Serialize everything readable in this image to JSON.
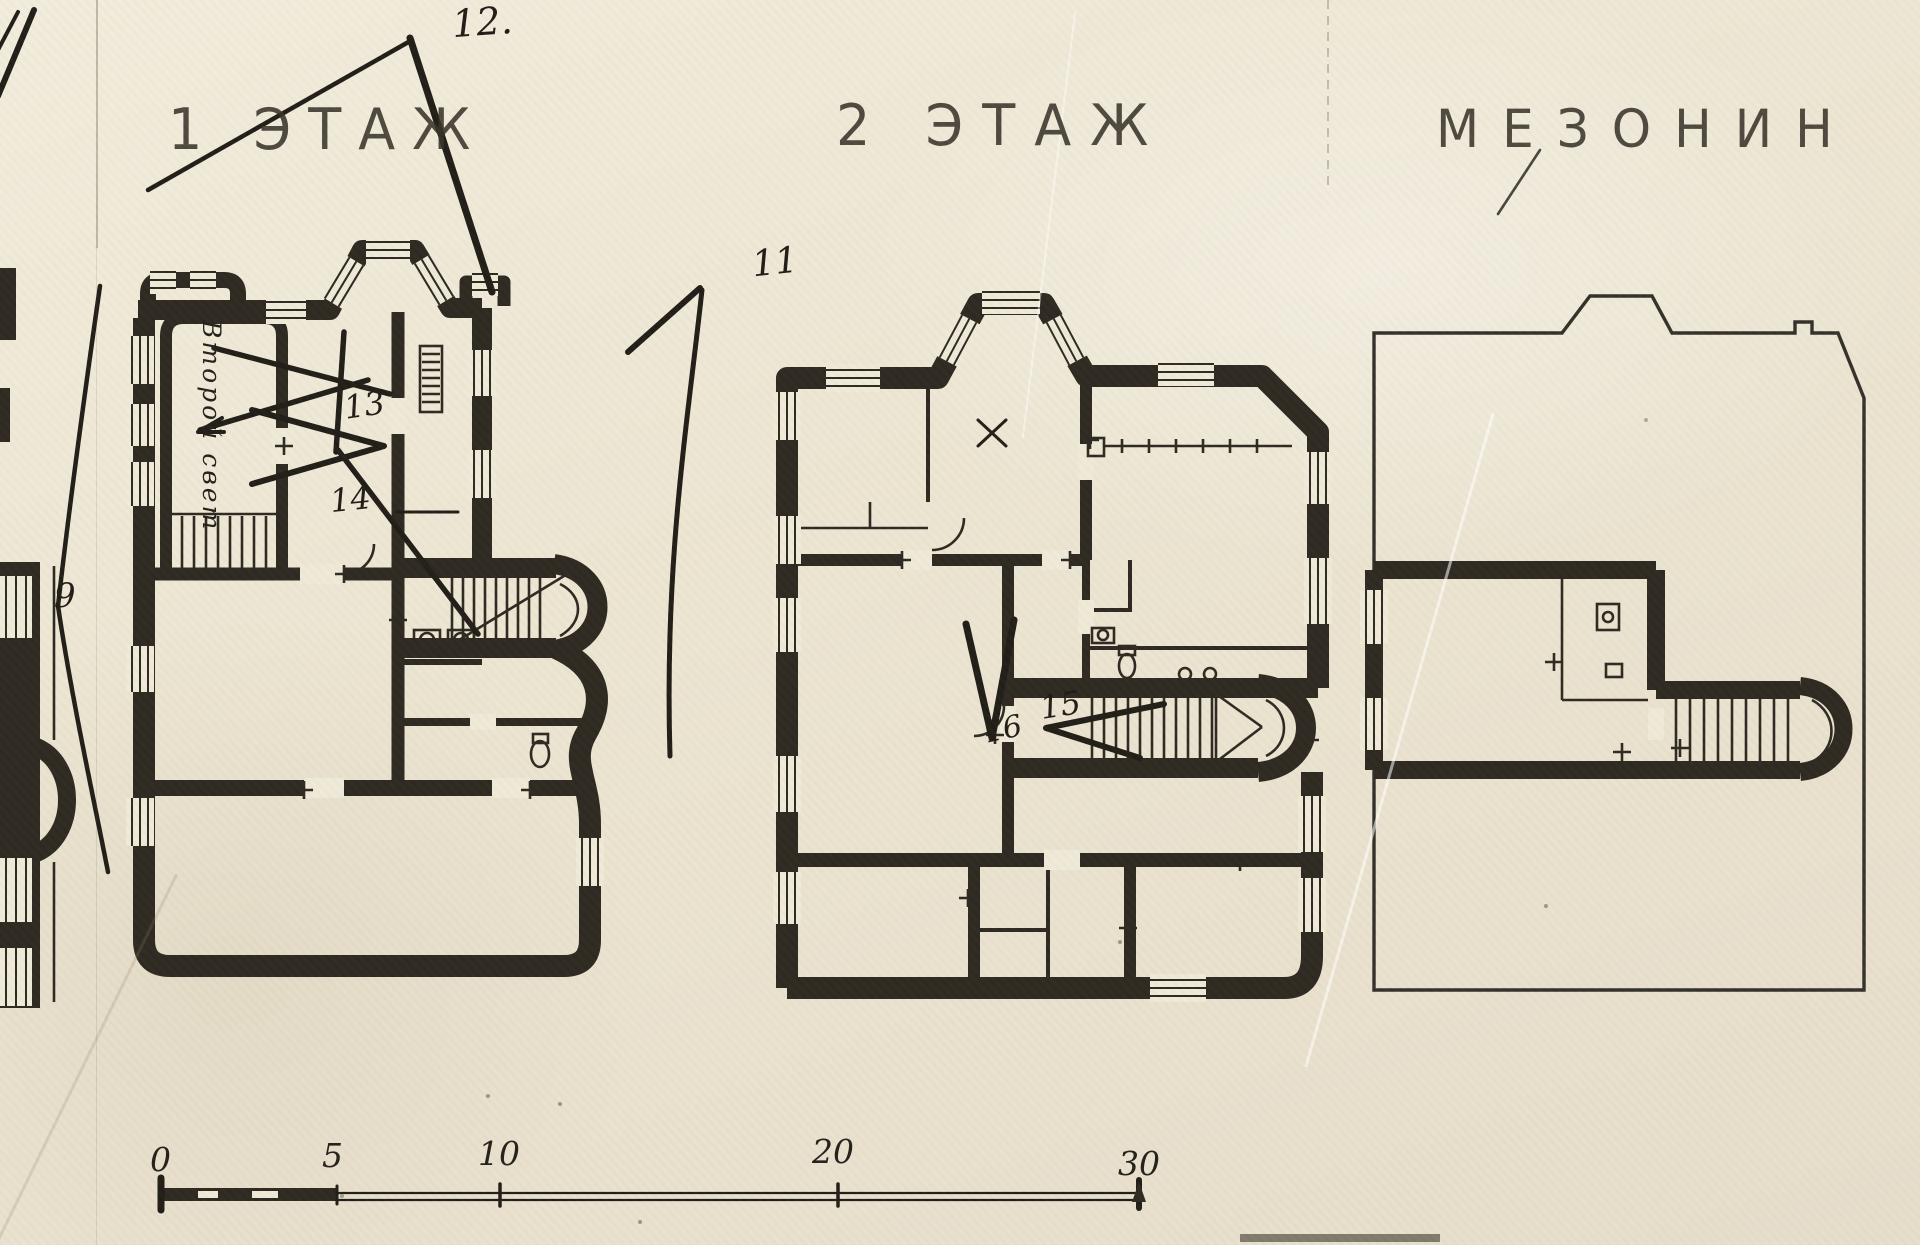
{
  "paper_color": "#ece5d2",
  "ink_color": "#2b2722",
  "titles": [
    {
      "id": "floor-1",
      "label": "1 ЭТАЖ"
    },
    {
      "id": "floor-2",
      "label": "2 ЭТАЖ"
    },
    {
      "id": "mezzanine",
      "label": "МЕЗОНИН"
    }
  ],
  "plan_note": {
    "label": "Второй свет"
  },
  "callouts": [
    {
      "id": "12",
      "label": "12."
    },
    {
      "id": "11",
      "label": "11"
    },
    {
      "id": "9",
      "label": "9"
    },
    {
      "id": "13",
      "label": "13"
    },
    {
      "id": "14",
      "label": "14"
    },
    {
      "id": "15",
      "label": "15"
    },
    {
      "id": "16",
      "label": "16"
    }
  ],
  "scale_bar": {
    "unit_labels": [
      "0",
      "5",
      "10",
      "20",
      "30"
    ]
  }
}
